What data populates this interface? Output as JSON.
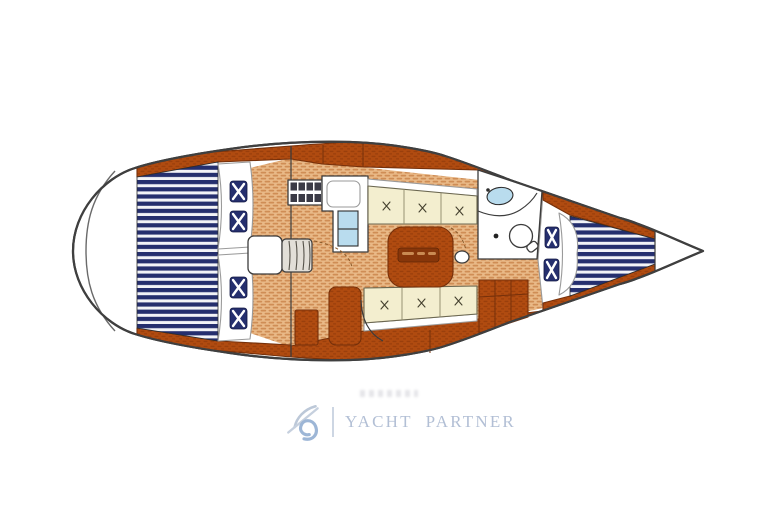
{
  "window": {
    "width": 772,
    "height": 519,
    "background": "#ffffff"
  },
  "diagram": {
    "name": "sailboat-interior-layout-plan",
    "view": "top-down floor plan, bow pointing right",
    "parts": [
      "stern-platform",
      "aft-double-berth",
      "aft-berth-cushions",
      "companionway-steps",
      "galley-stove",
      "galley-counter",
      "galley-sink-unit",
      "saloon-settee-port",
      "saloon-settee-starboard",
      "saloon-table",
      "head-compartment",
      "head-sink",
      "head-toilet",
      "storage-cabinets",
      "bow-v-berth",
      "anchor-locker"
    ]
  },
  "palette": {
    "hull_outline": "#3f3f3f",
    "wood_brown": "#b04b10",
    "wood_brown_dark": "#76300a",
    "floor_tan": "#e9b987",
    "floor_tan_dark": "#cf8d55",
    "navy": "#252f6e",
    "stripe_white": "#f2f3f7",
    "cream": "#f3eecf",
    "light_blue": "#b9dcee",
    "logo_blue": "#b2bfd5",
    "logo_icon_blue": "#9db6d6"
  },
  "logo": {
    "word1": "YACHT",
    "word2": "PARTNER",
    "icon": "yacht-partner-swirl-icon"
  }
}
